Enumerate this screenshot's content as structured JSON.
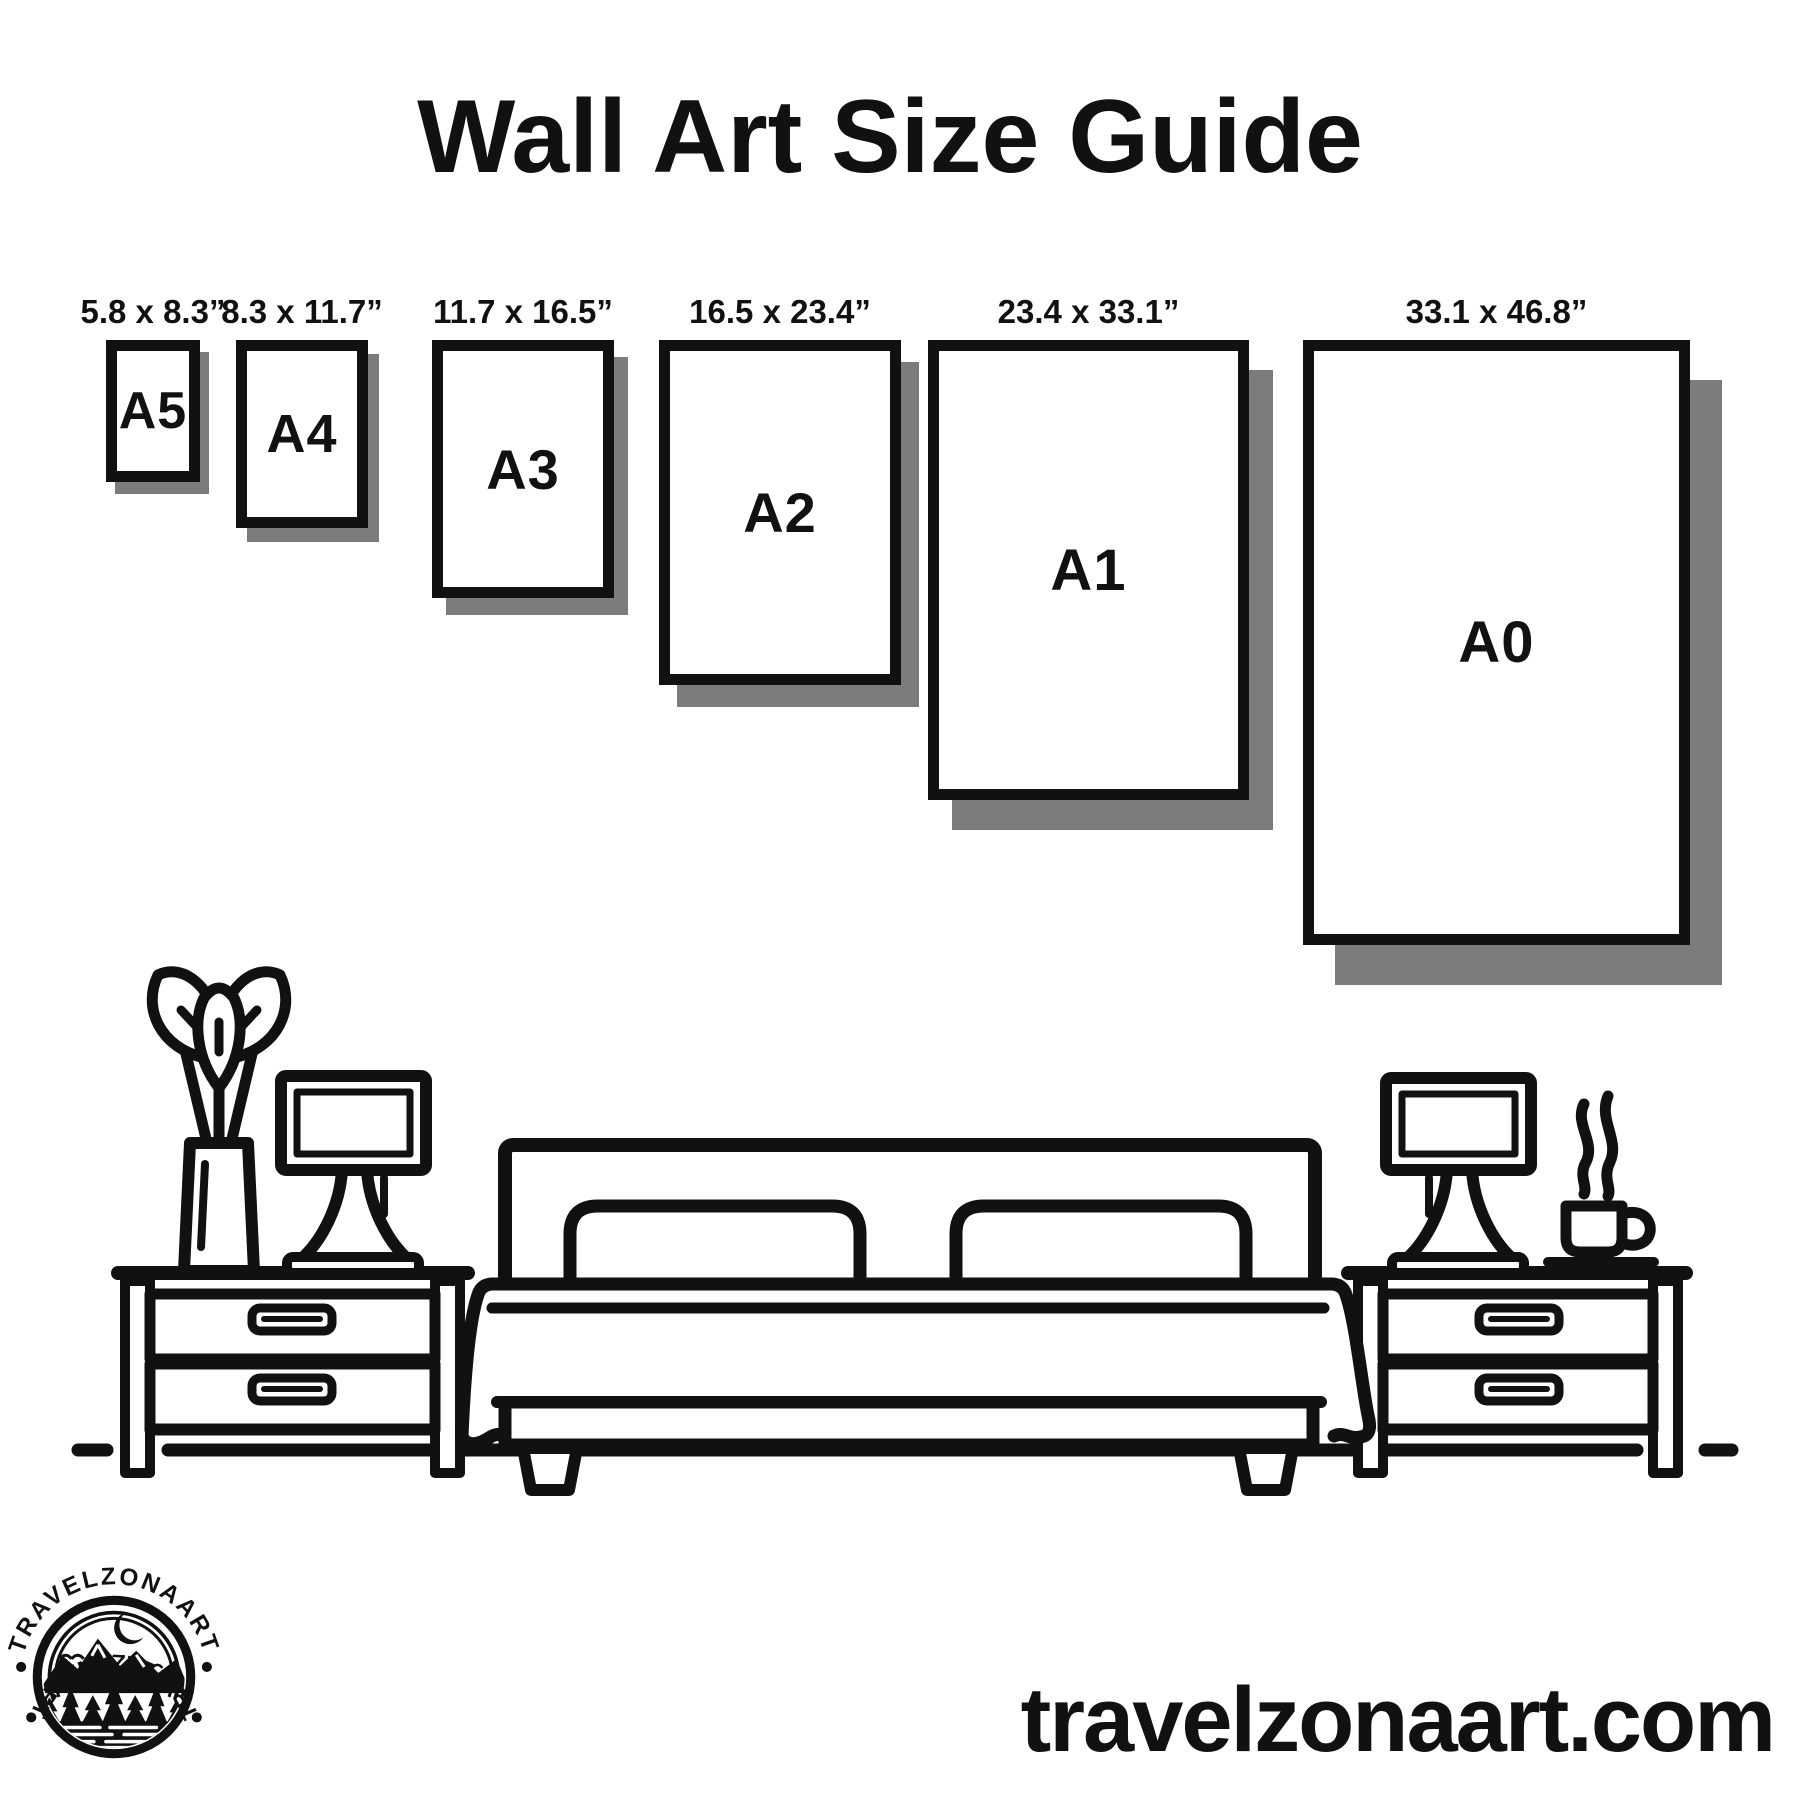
{
  "title": "Wall Art Size Guide",
  "website": "travelzonaart.com",
  "logo": {
    "arc_text_top": "TRAVELZONAART",
    "arc_text_bottom": "TRAVELZONAART"
  },
  "colors": {
    "ink": "#111111",
    "shadow": "#7c7c7c",
    "background": "#ffffff"
  },
  "frames": [
    {
      "id": "a5",
      "label": "A5",
      "dimensions": "5.8 x 8.3”",
      "x": 106,
      "y": 340,
      "w": 94,
      "h": 142,
      "shadow_dx": 9,
      "shadow_dy": 12,
      "label_size": 52
    },
    {
      "id": "a4",
      "label": "A4",
      "dimensions": "8.3 x 11.7”",
      "x": 236,
      "y": 340,
      "w": 132,
      "h": 188,
      "shadow_dx": 11,
      "shadow_dy": 14,
      "label_size": 54
    },
    {
      "id": "a3",
      "label": "A3",
      "dimensions": "11.7 x 16.5”",
      "x": 432,
      "y": 340,
      "w": 182,
      "h": 258,
      "shadow_dx": 14,
      "shadow_dy": 17,
      "label_size": 56
    },
    {
      "id": "a2",
      "label": "A2",
      "dimensions": "16.5 x 23.4”",
      "x": 659,
      "y": 340,
      "w": 242,
      "h": 345,
      "shadow_dx": 18,
      "shadow_dy": 22,
      "label_size": 56
    },
    {
      "id": "a1",
      "label": "A1",
      "dimensions": "23.4 x 33.1”",
      "x": 928,
      "y": 340,
      "w": 321,
      "h": 460,
      "shadow_dx": 24,
      "shadow_dy": 30,
      "label_size": 58
    },
    {
      "id": "a0",
      "label": "A0",
      "dimensions": "33.1 x 46.8”",
      "x": 1303,
      "y": 340,
      "w": 387,
      "h": 605,
      "shadow_dx": 32,
      "shadow_dy": 40,
      "label_size": 58
    }
  ],
  "scene_icons": [
    "potted-plant",
    "table-lamp",
    "nightstand",
    "double-bed",
    "pillow",
    "coffee-cup",
    "steam",
    "floor-line"
  ]
}
